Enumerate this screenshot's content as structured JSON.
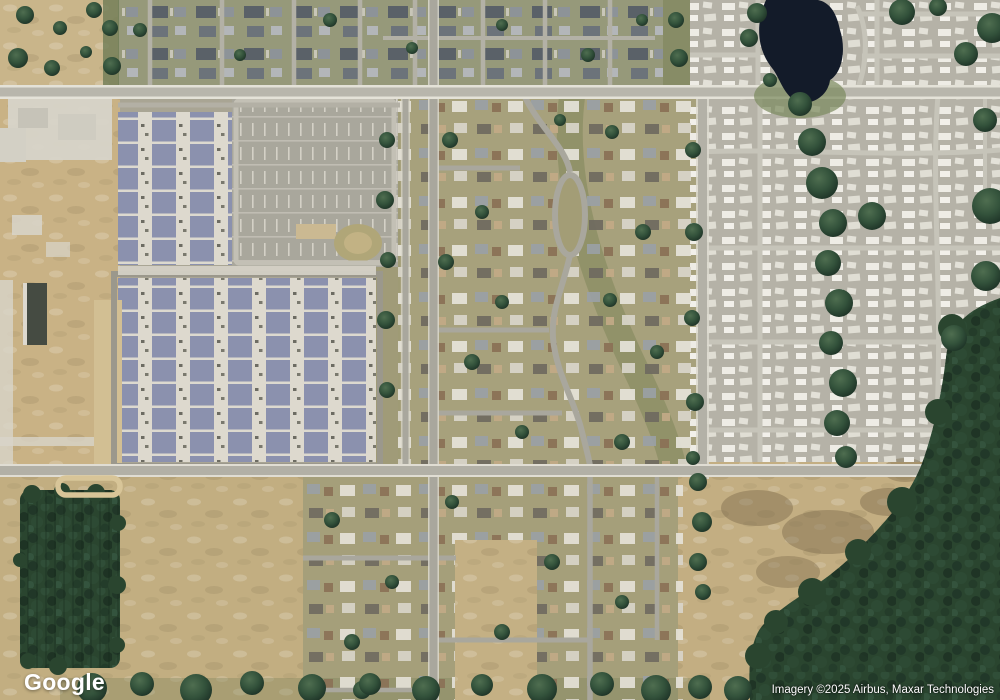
{
  "map": {
    "view_type": "satellite-imagery",
    "logo_text": "Google",
    "attribution_text": "Imagery ©2025 Airbus, Maxar Technologies",
    "colors": {
      "base_tan": "#c7b183",
      "scrub_tan": "#c9b58a",
      "top_band_ground": "#96997a",
      "suburb_ground": "#a7a17c",
      "bottom_suburb_ground": "#a59f7a",
      "park_ground": "#b5b2a7",
      "field_tan": "#c3ae82",
      "bottom_left_field": "#c2ae81",
      "construction_dirt": "#c9b285",
      "townhome_roof_blue": "#8b91ae",
      "storage_lot_gray": "#a9a79c",
      "main_road_gray": "#b8b6ac",
      "street_gray": "#a9a79d",
      "park_street": "#c6c4b9",
      "forest_green": "#2a452f",
      "pond_dark": "#131b29",
      "mottle_brown": "#7c6b4c"
    },
    "features": {
      "pond": "dark retention pond, top right",
      "mobile_home_park": "dense white mobile homes, right side",
      "townhome_development": "blue-roofed rowhouse blocks, left center",
      "construction_site": "graded dirt with building pads, far left",
      "residential_neighborhoods": "single-family homes, center and top",
      "forest": "dark tree stands, bottom left and bottom right",
      "open_fields": "tan scrub fields, bottom center and bottom right"
    }
  }
}
